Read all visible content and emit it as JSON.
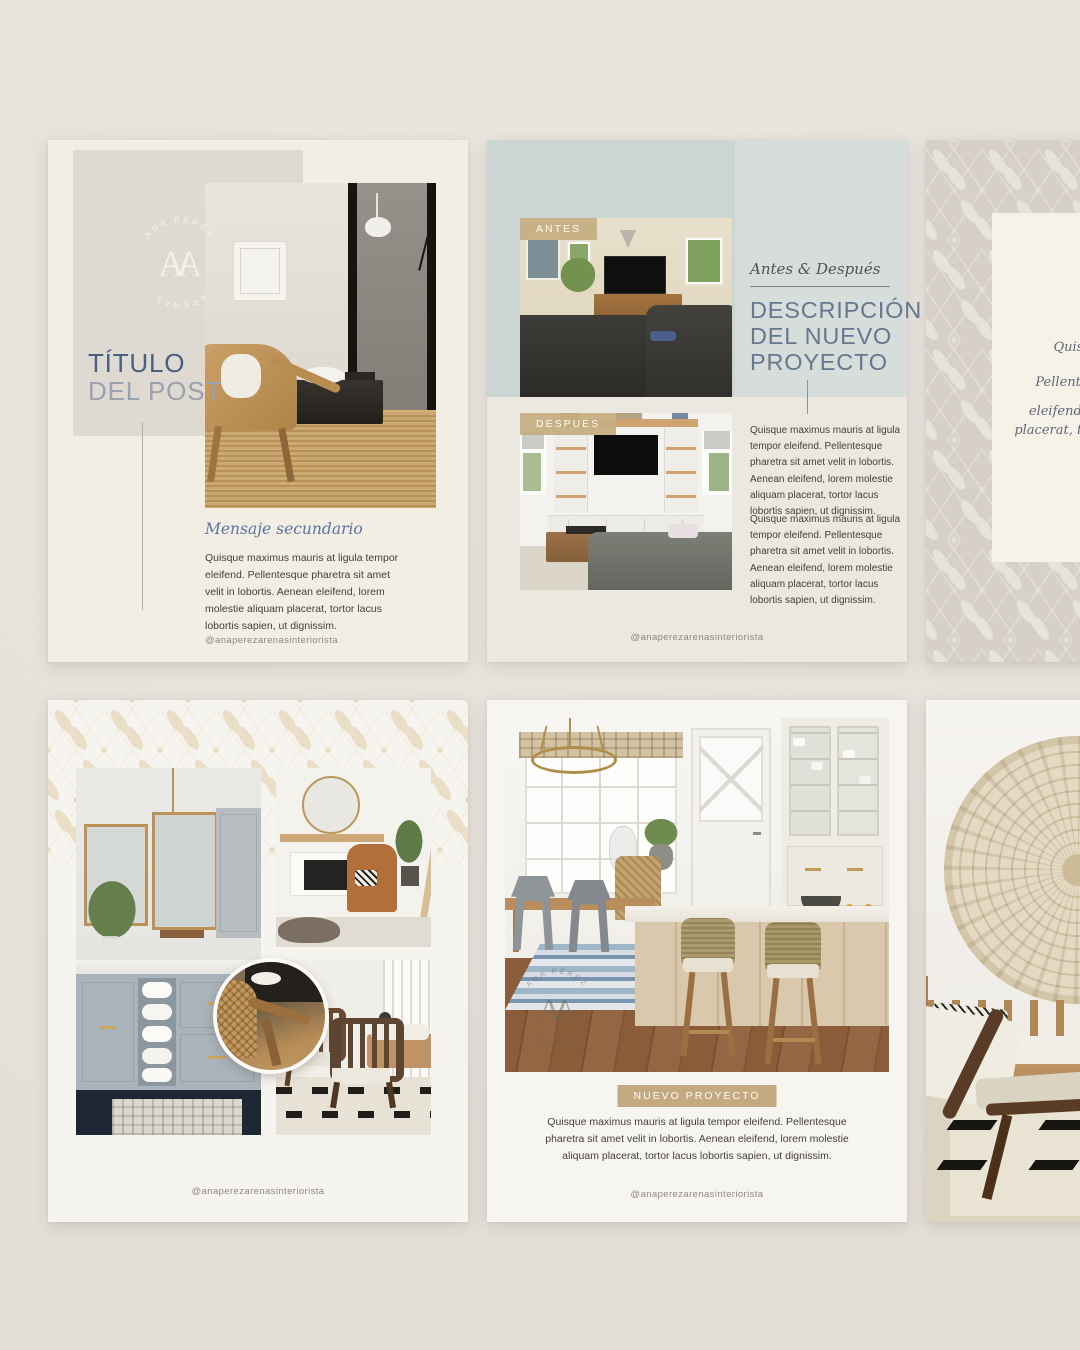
{
  "brand": {
    "handle": "@anaperezarenasinteriorista",
    "logo": {
      "top_text": "ANA PÉREZ",
      "bottom_text": "ARENAS",
      "monogram_left": "A",
      "monogram_right": "A"
    }
  },
  "colors": {
    "page_background": "#e6e1db",
    "cream_card": "#f2eee3",
    "greige_block": "#dedad2",
    "band_blue": "#ccd5d4",
    "accent_blue": "#4b5f82",
    "muted_blue": "#9aa2af",
    "heading_blue": "#64788e",
    "tan_label": "#c4ac82",
    "pattern_cream": "#eadfc6"
  },
  "card_title_post": {
    "title_line1": "TÍTULO",
    "title_line2": "DEL POST",
    "secondary_message": "Mensaje secundario",
    "body": "Quisque maximus mauris at ligula tempor eleifend. Pellentesque pharetra sit amet velit in lobortis. Aenean eleifend, lorem molestie aliquam placerat, tortor lacus lobortis sapien, ut dignissim."
  },
  "card_antes_despues": {
    "label_before": "ANTES",
    "label_after": "DESPUÉS",
    "eyebrow": "Antes & Después",
    "title_lines": [
      "DESCRIPCIÓN",
      "DEL NUEVO",
      "PROYECTO"
    ],
    "paragraphs": [
      "Quisque maximus mauris at ligula tempor eleifend. Pellentesque pharetra sit amet velit in lobortis. Aenean eleifend, lorem molestie aliquam placerat, tortor lacus lobortis sapien, ut dignissim.",
      "Quisque maximus mauris at ligula tempor eleifend. Pellentesque pharetra sit amet velit in lobortis. Aenean eleifend, lorem molestie aliquam placerat, tortor lacus lobortis sapien, ut dignissim."
    ]
  },
  "card_quote": {
    "lines": [
      "Quisque maximus mauris",
      "Pellentesque pharetra sit amet",
      "eleifend, lorem molestie aliquam placerat, tortor lacus lobortis sapien."
    ]
  },
  "card_nuevo_proyecto": {
    "label": "NUEVO PROYECTO",
    "body": "Quisque maximus mauris at ligula tempor eleifend. Pellentesque pharetra sit amet velit in lobortis. Aenean eleifend, lorem molestie aliquam placerat, tortor lacus lobortis sapien, ut dignissim."
  }
}
